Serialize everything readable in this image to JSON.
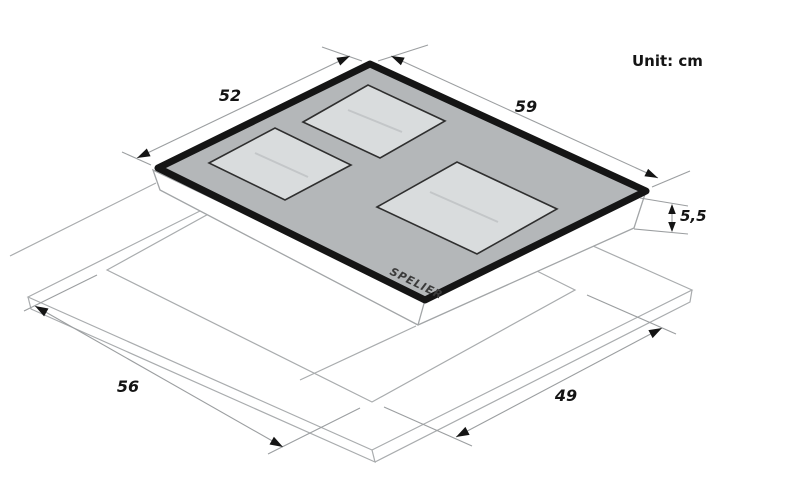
{
  "unit_note": "Unit: cm",
  "brand_logo": "SPELIER",
  "dims": {
    "hob_top_depth": "52",
    "hob_top_width": "59",
    "hob_body_height": "5,5",
    "cutout_depth": "56",
    "cutout_width": "49"
  },
  "colors": {
    "glass_fill": "#b4b7b9",
    "glass_rim": "#151515",
    "zone_fill": "#d9dcdd",
    "zone_stroke": "#2f2f2f",
    "zone_reflection": "#c3c6c8",
    "body_fill": "#ffffff",
    "drawing_line": "#a9acae",
    "dim_line": "#9b9ea0",
    "dim_ink": "#141414"
  }
}
